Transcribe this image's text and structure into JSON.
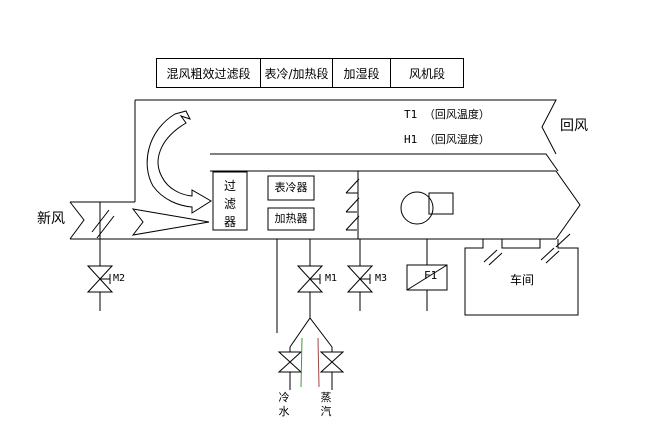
{
  "sections": {
    "items": [
      {
        "label": "混风粗效过滤段"
      },
      {
        "label": "表冷/加热段"
      },
      {
        "label": "加湿段"
      },
      {
        "label": "风机段"
      }
    ]
  },
  "ducts": {
    "return_air_label": "回风",
    "fresh_air_label": "新风",
    "t1_sensor_label": "T1 （回风温度）",
    "h1_sensor_label": "H1 （回风湿度）"
  },
  "components": {
    "filter": "过滤器",
    "cooler": "表冷器",
    "heater": "加热器",
    "workshop": "车间"
  },
  "valves": {
    "m2": "M2",
    "m1": "M1",
    "m3": "M3",
    "f1": "F1"
  },
  "pipes": {
    "cold_water": "冷水",
    "steam": "蒸汽"
  },
  "icons": {
    "fan": "fan-circle",
    "valve": "bowtie-valve",
    "damper": "slash-damper",
    "flow_arrows": "ribbon-arrows"
  },
  "colors": {
    "line": "#000000",
    "background": "#ffffff",
    "cold_water_arrow": "#3a9d3a",
    "steam_arrow": "#a04545"
  }
}
